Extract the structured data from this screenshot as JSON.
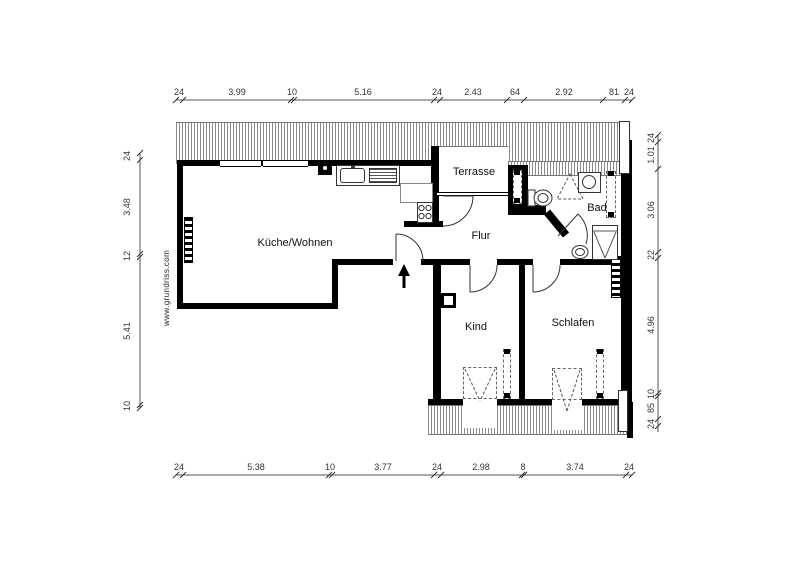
{
  "title": "apartment-floor-plan",
  "watermark": {
    "text": "www.grundriss.com"
  },
  "rooms": {
    "kueche": {
      "label": "Küche/Wohnen"
    },
    "terrasse": {
      "label": "Terrasse"
    },
    "flur": {
      "label": "Flur"
    },
    "bad": {
      "label": "Bad"
    },
    "kind": {
      "label": "Kind"
    },
    "schlafen": {
      "label": "Schlafen"
    }
  },
  "dimensions": {
    "top": [
      "24",
      "3.99",
      "10",
      "5.16",
      "24",
      "2.43",
      "64",
      "2.92",
      "81",
      "24"
    ],
    "bottom": [
      "24",
      "5.38",
      "10",
      "3.77",
      "24",
      "2.98",
      "8",
      "3.74",
      "24"
    ],
    "left": [
      "24",
      "3.48",
      "12",
      "5.41",
      "10"
    ],
    "right": [
      "24",
      "1.01",
      "3.06",
      "22",
      "4.96",
      "10",
      "85",
      "24"
    ]
  },
  "icons": {
    "entry_arrow": "entrance-direction-arrow",
    "stove": "stove-4-burners",
    "sink": "kitchen-sink-with-drainer",
    "toilet": "toilet",
    "shower": "shower",
    "washbasin": "washbasin"
  },
  "colors": {
    "wall": "#000000",
    "hatch_line": "#8a8a8a",
    "dim_line": "#555555",
    "text": "#333333"
  }
}
